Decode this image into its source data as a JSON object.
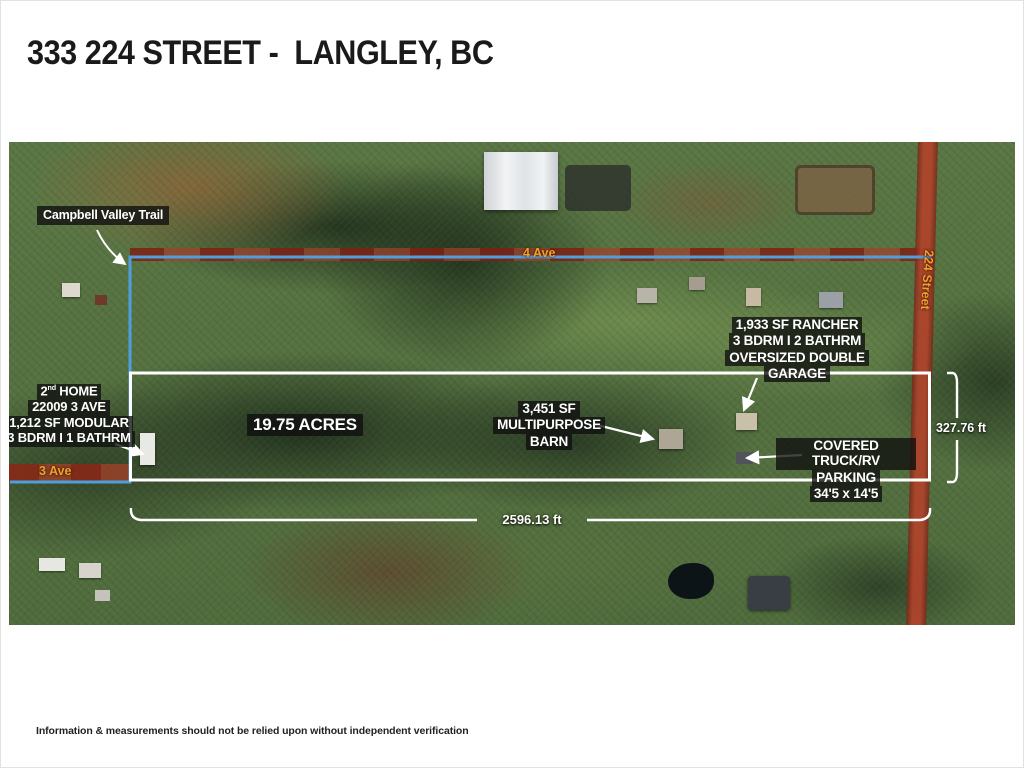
{
  "page": {
    "title": "333 224 STREET -  LANGLEY, BC",
    "disclaimer": "Information & measurements should not be relied upon without independent verification"
  },
  "map": {
    "trail_label": "Campbell Valley Trail",
    "acreage_label": "19.75 ACRES",
    "streets": {
      "ave4": "4 Ave",
      "street224": "224 Street",
      "ave3": "3 Ave"
    },
    "rancher": {
      "line1": "1,933 SF  RANCHER",
      "line2": "3 BDRM  I  2 BATHRM",
      "line3": "OVERSIZED DOUBLE",
      "line4": "GARAGE"
    },
    "second_home": {
      "num": "2",
      "sup": "nd",
      "suffix": " HOME",
      "line2": "22009  3 AVE",
      "line3": "1,212 SF MODULAR",
      "line4": "3 BDRM  I  1 BATHRM"
    },
    "barn": {
      "line1": "3,451 SF",
      "line2": "MULTIPURPOSE",
      "line3": "BARN"
    },
    "parking": {
      "line1": "COVERED TRUCK/RV",
      "line2": "PARKING",
      "line3": "34'5 x 14'5"
    },
    "measurements": {
      "frontage": "2596.13 ft",
      "depth": "327.76 ft"
    },
    "colors": {
      "boundary_blue": "#4f9fdf",
      "road_red": "#a8402a",
      "street_label_orange": "#f2a12d",
      "annotation_bg": "#0e0e0e",
      "annotation_text": "#ffffff"
    }
  }
}
